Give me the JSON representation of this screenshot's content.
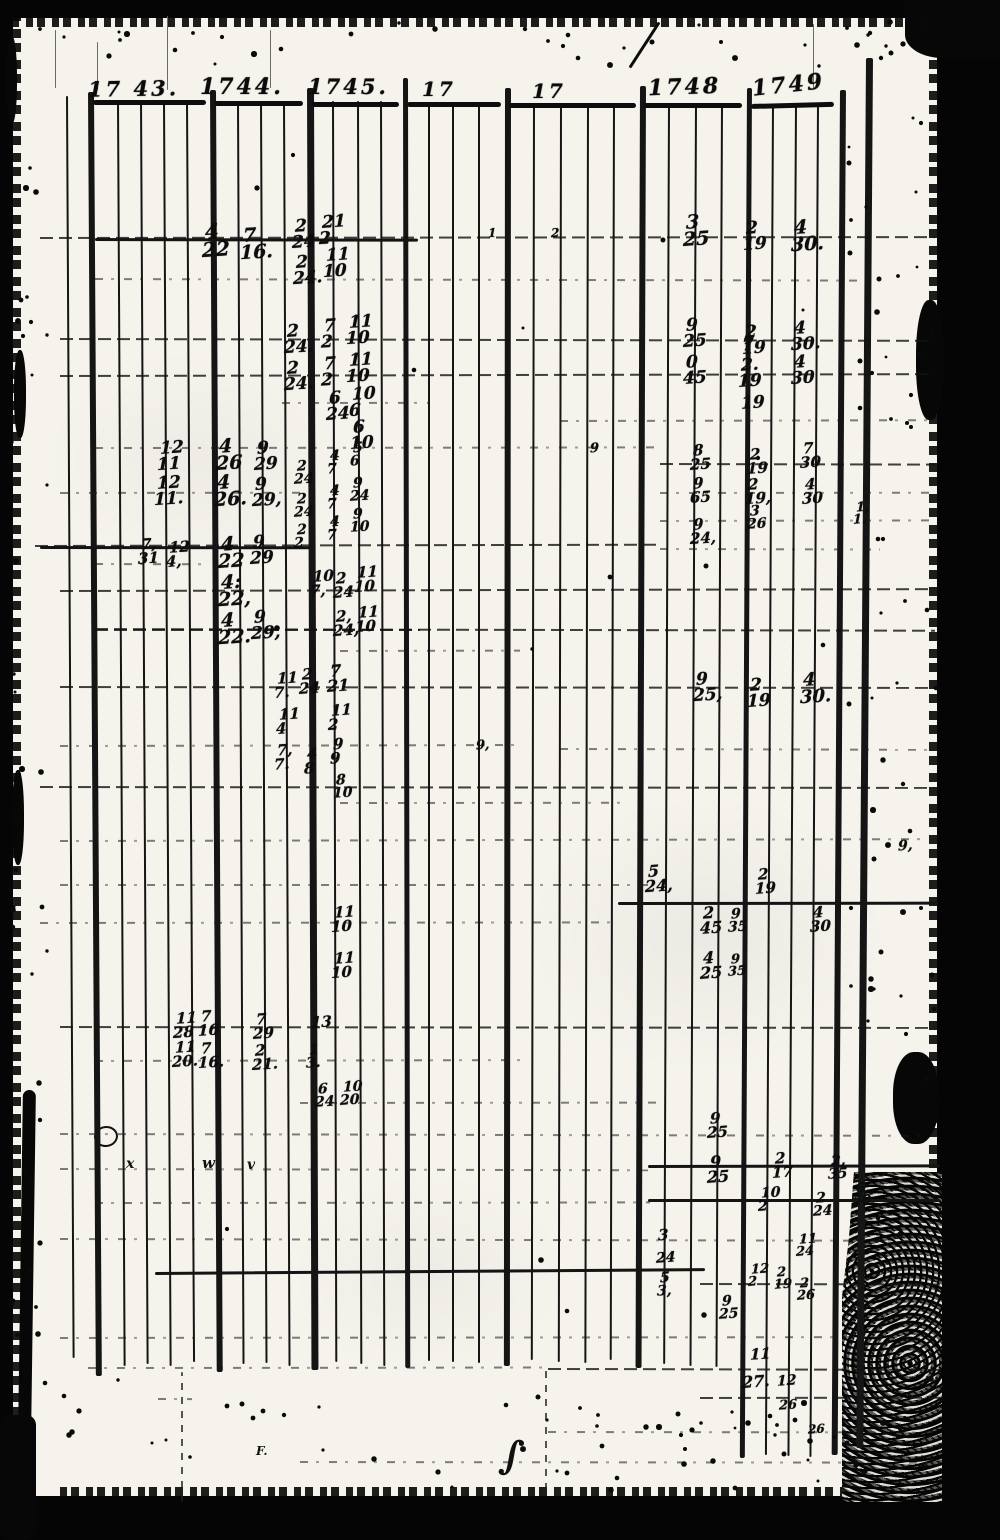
{
  "document": {
    "kind": "scanned handwritten ledger page",
    "header": {
      "years": [
        "17 43.",
        "1744.",
        "1745.",
        "17",
        "17",
        "1748",
        "1749"
      ]
    },
    "ink_color": "#0d0d0d",
    "paper_color": "#f5f3ec"
  },
  "entries": [
    {
      "x": 205,
      "y": 222,
      "t": "4",
      "b": "22",
      "s": 20
    },
    {
      "x": 243,
      "y": 227,
      "t": "7",
      "b": "16.",
      "s": 19
    },
    {
      "x": 295,
      "y": 219,
      "t": "2",
      "b": "24"
    },
    {
      "x": 322,
      "y": 215,
      "t": "21",
      "b": "2"
    },
    {
      "x": 296,
      "y": 255,
      "t": "2",
      "b": "24."
    },
    {
      "x": 326,
      "y": 248,
      "t": "11",
      "b": "10"
    },
    {
      "x": 686,
      "y": 214,
      "t": "3",
      "b": "25",
      "s": 19
    },
    {
      "x": 746,
      "y": 221,
      "t": "2",
      "b": "19"
    },
    {
      "x": 794,
      "y": 219,
      "t": "4",
      "b": "30.",
      "s": 19
    },
    {
      "x": 488,
      "y": 228,
      "t": "1",
      "b": "",
      "s": 12
    },
    {
      "x": 551,
      "y": 228,
      "t": "2",
      "b": "",
      "s": 12
    },
    {
      "x": 287,
      "y": 324,
      "t": "2",
      "b": "24."
    },
    {
      "x": 324,
      "y": 319,
      "t": "7",
      "b": "2"
    },
    {
      "x": 349,
      "y": 315,
      "t": "11",
      "b": "10"
    },
    {
      "x": 287,
      "y": 361,
      "t": "2",
      "b": "24."
    },
    {
      "x": 324,
      "y": 357,
      "t": "7",
      "b": "2"
    },
    {
      "x": 349,
      "y": 353,
      "t": "11",
      "b": "10"
    },
    {
      "x": 329,
      "y": 391,
      "t": "6",
      "b": "24"
    },
    {
      "x": 352,
      "y": 387,
      "t": "10",
      "b": "6"
    },
    {
      "x": 353,
      "y": 420,
      "t": "6",
      "b": "10"
    },
    {
      "x": 686,
      "y": 318,
      "t": "9",
      "b": "25"
    },
    {
      "x": 745,
      "y": 325,
      "t": "2",
      "b": "19"
    },
    {
      "x": 794,
      "y": 321,
      "t": "4",
      "b": "30."
    },
    {
      "x": 686,
      "y": 355,
      "t": "0",
      "b": "45"
    },
    {
      "x": 742,
      "y": 338,
      "t": "7",
      "b": ""
    },
    {
      "x": 741,
      "y": 358,
      "t": "2.",
      "b": "19"
    },
    {
      "x": 741,
      "y": 396,
      "t": "19",
      "b": ""
    },
    {
      "x": 794,
      "y": 355,
      "t": "4",
      "b": "30"
    },
    {
      "x": 160,
      "y": 441,
      "t": "12",
      "b": "11"
    },
    {
      "x": 219,
      "y": 438,
      "t": "4",
      "b": "26",
      "s": 19
    },
    {
      "x": 257,
      "y": 441,
      "t": "9",
      "b": "29"
    },
    {
      "x": 157,
      "y": 476,
      "t": "12",
      "b": "11."
    },
    {
      "x": 217,
      "y": 474,
      "t": "4",
      "b": "26.",
      "s": 19
    },
    {
      "x": 255,
      "y": 477,
      "t": "9",
      "b": "29,"
    },
    {
      "x": 297,
      "y": 460,
      "t": "2",
      "b": "24",
      "s": 14
    },
    {
      "x": 330,
      "y": 450,
      "t": "4",
      "b": "7",
      "s": 14
    },
    {
      "x": 353,
      "y": 442,
      "t": "5",
      "b": "6",
      "s": 14
    },
    {
      "x": 297,
      "y": 493,
      "t": "2",
      "b": "24",
      "s": 14
    },
    {
      "x": 330,
      "y": 485,
      "t": "4",
      "b": "7",
      "s": 14
    },
    {
      "x": 353,
      "y": 477,
      "t": "9",
      "b": "24",
      "s": 14
    },
    {
      "x": 297,
      "y": 524,
      "t": "2",
      "b": "2",
      "s": 14
    },
    {
      "x": 330,
      "y": 516,
      "t": "4",
      "b": "7",
      "s": 14
    },
    {
      "x": 353,
      "y": 508,
      "t": "9",
      "b": "10",
      "s": 14
    },
    {
      "x": 693,
      "y": 444,
      "t": "8",
      "b": "25",
      "s": 15
    },
    {
      "x": 750,
      "y": 448,
      "t": "2",
      "b": "19",
      "s": 15
    },
    {
      "x": 803,
      "y": 442,
      "t": "7",
      "b": "30",
      "s": 15
    },
    {
      "x": 693,
      "y": 477,
      "t": "9",
      "b": "65",
      "s": 15
    },
    {
      "x": 748,
      "y": 478,
      "t": "2",
      "b": "19,",
      "s": 15
    },
    {
      "x": 805,
      "y": 478,
      "t": "4",
      "b": "30",
      "s": 15
    },
    {
      "x": 693,
      "y": 518,
      "t": "9",
      "b": "24,",
      "s": 15
    },
    {
      "x": 750,
      "y": 505,
      "t": "3",
      "b": "26",
      "s": 14
    },
    {
      "x": 856,
      "y": 502,
      "t": "1,",
      "b": "1.",
      "s": 13
    },
    {
      "x": 141,
      "y": 538,
      "t": "7,",
      "b": "31",
      "s": 15
    },
    {
      "x": 169,
      "y": 541,
      "t": "12",
      "b": "4,",
      "s": 15
    },
    {
      "x": 221,
      "y": 536,
      "t": "4",
      "b": "22",
      "s": 19
    },
    {
      "x": 253,
      "y": 535,
      "t": "9",
      "b": "29"
    },
    {
      "x": 221,
      "y": 574,
      "t": "4:",
      "b": "22,",
      "s": 19
    },
    {
      "x": 313,
      "y": 570,
      "t": "10",
      "b": "7,",
      "s": 15
    },
    {
      "x": 336,
      "y": 572,
      "t": "2",
      "b": "24",
      "s": 15
    },
    {
      "x": 357,
      "y": 566,
      "t": "11",
      "b": "10",
      "s": 15
    },
    {
      "x": 221,
      "y": 612,
      "t": "4",
      "b": "22.",
      "s": 19
    },
    {
      "x": 254,
      "y": 610,
      "t": "9",
      "b": "29,"
    },
    {
      "x": 336,
      "y": 610,
      "t": "2,",
      "b": "24,",
      "s": 15
    },
    {
      "x": 358,
      "y": 606,
      "t": "11",
      "b": "10",
      "s": 15
    },
    {
      "x": 277,
      "y": 672,
      "t": "11",
      "b": "7.",
      "s": 15
    },
    {
      "x": 302,
      "y": 668,
      "t": "2",
      "b": "24",
      "s": 15
    },
    {
      "x": 330,
      "y": 664,
      "t": "7",
      "b": "21",
      "s": 16
    },
    {
      "x": 279,
      "y": 708,
      "t": "11",
      "b": "4",
      "s": 15
    },
    {
      "x": 331,
      "y": 704,
      "t": "11",
      "b": "2",
      "s": 15
    },
    {
      "x": 277,
      "y": 744,
      "t": "7,",
      "b": "7.",
      "s": 15
    },
    {
      "x": 307,
      "y": 748,
      "t": "4",
      "b": "8",
      "s": 15
    },
    {
      "x": 333,
      "y": 738,
      "t": "9",
      "b": "9",
      "s": 15
    },
    {
      "x": 336,
      "y": 774,
      "t": "8",
      "b": "10",
      "s": 14
    },
    {
      "x": 696,
      "y": 672,
      "t": "9",
      "b": "25,",
      "s": 17
    },
    {
      "x": 750,
      "y": 678,
      "t": "2",
      "b": "19",
      "s": 17
    },
    {
      "x": 803,
      "y": 672,
      "t": "4",
      "b": "30.",
      "s": 18
    },
    {
      "x": 476,
      "y": 740,
      "t": "9,",
      "b": "",
      "s": 13
    },
    {
      "x": 590,
      "y": 443,
      "t": "9",
      "b": "",
      "s": 13
    },
    {
      "x": 648,
      "y": 864,
      "t": "5",
      "b": "24,",
      "s": 16
    },
    {
      "x": 758,
      "y": 868,
      "t": "2",
      "b": "19",
      "s": 15
    },
    {
      "x": 334,
      "y": 906,
      "t": "11",
      "b": "10",
      "s": 15
    },
    {
      "x": 334,
      "y": 952,
      "t": "11",
      "b": "10",
      "s": 15
    },
    {
      "x": 703,
      "y": 906,
      "t": "2",
      "b": "45",
      "s": 16
    },
    {
      "x": 731,
      "y": 908,
      "t": "9",
      "b": "35",
      "s": 14
    },
    {
      "x": 813,
      "y": 906,
      "t": "4",
      "b": "30",
      "s": 15
    },
    {
      "x": 703,
      "y": 951,
      "t": "4",
      "b": "25",
      "s": 16
    },
    {
      "x": 731,
      "y": 954,
      "t": "9",
      "b": "35",
      "s": 13
    },
    {
      "x": 898,
      "y": 840,
      "t": "9,",
      "b": "",
      "s": 14
    },
    {
      "x": 176,
      "y": 1012,
      "t": "11",
      "b": "28",
      "s": 15
    },
    {
      "x": 201,
      "y": 1010,
      "t": "7",
      "b": "16",
      "s": 15
    },
    {
      "x": 256,
      "y": 1013,
      "t": "7",
      "b": "29",
      "s": 15
    },
    {
      "x": 311,
      "y": 1016,
      "t": "13",
      "b": "",
      "s": 15
    },
    {
      "x": 175,
      "y": 1041,
      "t": "11",
      "b": "20.",
      "s": 15
    },
    {
      "x": 201,
      "y": 1042,
      "t": "7",
      "b": "16.",
      "s": 15
    },
    {
      "x": 255,
      "y": 1044,
      "t": "2",
      "b": "21.",
      "s": 15
    },
    {
      "x": 309,
      "y": 1044,
      "t": "1",
      "b": "3.",
      "s": 14
    },
    {
      "x": 318,
      "y": 1083,
      "t": "6",
      "b": "24",
      "s": 14
    },
    {
      "x": 343,
      "y": 1081,
      "t": "10",
      "b": "20",
      "s": 14
    },
    {
      "x": 710,
      "y": 1112,
      "t": "9",
      "b": "25",
      "s": 15
    },
    {
      "x": 710,
      "y": 1155,
      "t": "9",
      "b": "25",
      "s": 16
    },
    {
      "x": 775,
      "y": 1152,
      "t": "2",
      "b": "17",
      "s": 15
    },
    {
      "x": 831,
      "y": 1155,
      "t": "2,",
      "b": "35",
      "s": 14
    },
    {
      "x": 761,
      "y": 1187,
      "t": "10",
      "b": "2",
      "s": 14
    },
    {
      "x": 816,
      "y": 1192,
      "t": "2",
      "b": "24",
      "s": 14
    },
    {
      "x": 856,
      "y": 1183,
      "t": "6,",
      "b": "50",
      "s": 13
    },
    {
      "x": 658,
      "y": 1229,
      "t": "3",
      "b": "",
      "s": 15
    },
    {
      "x": 656,
      "y": 1252,
      "t": "24",
      "b": "",
      "s": 14
    },
    {
      "x": 660,
      "y": 1272,
      "t": "5",
      "b": "3,",
      "s": 14
    },
    {
      "x": 751,
      "y": 1264,
      "t": "12",
      "b": "2",
      "s": 13
    },
    {
      "x": 777,
      "y": 1267,
      "t": "2",
      "b": "19",
      "s": 13
    },
    {
      "x": 799,
      "y": 1234,
      "t": "11",
      "b": "24",
      "s": 13
    },
    {
      "x": 800,
      "y": 1278,
      "t": "2",
      "b": "26",
      "s": 13
    },
    {
      "x": 722,
      "y": 1295,
      "t": "9",
      "b": "25",
      "s": 14
    },
    {
      "x": 750,
      "y": 1348,
      "t": "11",
      "b": "",
      "s": 15
    },
    {
      "x": 742,
      "y": 1375,
      "t": "27.",
      "b": "",
      "s": 16
    },
    {
      "x": 777,
      "y": 1375,
      "t": "12",
      "b": "",
      "s": 14
    },
    {
      "x": 779,
      "y": 1400,
      "t": "26",
      "b": "",
      "s": 13
    },
    {
      "x": 808,
      "y": 1424,
      "t": "26",
      "b": "",
      "s": 12
    }
  ],
  "marks": [
    {
      "x": 126,
      "y": 1156,
      "text": "x",
      "s": 14
    },
    {
      "x": 202,
      "y": 1154,
      "text": "w",
      "s": 15
    },
    {
      "x": 247,
      "y": 1157,
      "text": "v",
      "s": 14
    },
    {
      "x": 256,
      "y": 1444,
      "text": "F.",
      "s": 12
    },
    {
      "x": 500,
      "y": 1432,
      "text": "∫",
      "s": 40,
      "rot": 8
    }
  ],
  "grid": {
    "verticals": [
      [
        66,
        96,
        1358,
        2,
        -0.3
      ],
      [
        88,
        92,
        1376,
        6,
        -0.35
      ],
      [
        117,
        100,
        1366,
        2,
        -0.3
      ],
      [
        140,
        100,
        1364,
        2,
        -0.3
      ],
      [
        163,
        101,
        1366,
        2,
        -0.3
      ],
      [
        186,
        101,
        1362,
        2,
        -0.32
      ],
      [
        210,
        90,
        1372,
        6,
        -0.3
      ],
      [
        237,
        101,
        1364,
        2,
        -0.25
      ],
      [
        260,
        101,
        1363,
        2,
        -0.25
      ],
      [
        283,
        101,
        1366,
        2,
        -0.25
      ],
      [
        307,
        88,
        1370,
        7,
        -0.2
      ],
      [
        332,
        101,
        1362,
        2,
        -0.15
      ],
      [
        357,
        101,
        1364,
        2,
        -0.15
      ],
      [
        380,
        101,
        1366,
        2,
        -0.15
      ],
      [
        403,
        78,
        1368,
        5,
        -0.1
      ],
      [
        428,
        104,
        1361,
        2,
        0
      ],
      [
        452,
        104,
        1362,
        2,
        0
      ],
      [
        478,
        104,
        1363,
        2,
        0
      ],
      [
        505,
        88,
        1366,
        6,
        0.05
      ],
      [
        533,
        104,
        1360,
        2,
        0.1
      ],
      [
        560,
        104,
        1362,
        2,
        0.1
      ],
      [
        587,
        104,
        1363,
        2,
        0.12
      ],
      [
        613,
        104,
        1360,
        2,
        0.15
      ],
      [
        640,
        86,
        1368,
        6,
        0.2
      ],
      [
        668,
        105,
        1364,
        2,
        0.22
      ],
      [
        695,
        105,
        1366,
        2,
        0.25
      ],
      [
        721,
        105,
        1367,
        2,
        0.25
      ],
      [
        747,
        88,
        1458,
        5,
        0.3
      ],
      [
        772,
        105,
        1455,
        2,
        0.3
      ],
      [
        795,
        105,
        1456,
        2,
        0.32
      ],
      [
        817,
        105,
        1457,
        2,
        0.32
      ],
      [
        840,
        90,
        1455,
        6,
        0.35
      ],
      [
        866,
        58,
        1448,
        7,
        0.4
      ]
    ],
    "verticals_faint": [
      [
        181,
        1372,
        1502,
        2,
        "dashv"
      ],
      [
        545,
        1370,
        1490,
        2,
        "dashv"
      ],
      [
        167,
        16,
        90,
        1,
        "faint"
      ],
      [
        97,
        42,
        90,
        1,
        "faint"
      ],
      [
        270,
        30,
        88,
        1,
        "faint"
      ],
      [
        813,
        24,
        88,
        1,
        "faint"
      ],
      [
        55,
        30,
        88,
        1,
        "faint"
      ]
    ],
    "horizontals": [
      [
        40,
        935,
        237,
        "m"
      ],
      [
        95,
        872,
        278,
        "d"
      ],
      [
        60,
        935,
        338,
        "m"
      ],
      [
        60,
        935,
        375,
        "m"
      ],
      [
        282,
        430,
        402,
        "d"
      ],
      [
        560,
        935,
        420,
        "d"
      ],
      [
        95,
        655,
        447,
        "d"
      ],
      [
        660,
        935,
        463,
        "m"
      ],
      [
        60,
        300,
        492,
        "d"
      ],
      [
        660,
        935,
        492,
        "d"
      ],
      [
        660,
        935,
        520,
        "d"
      ],
      [
        35,
        660,
        545,
        "m"
      ],
      [
        660,
        880,
        548,
        "d"
      ],
      [
        95,
        210,
        563,
        "d"
      ],
      [
        60,
        935,
        590,
        "m"
      ],
      [
        95,
        935,
        628,
        "m"
      ],
      [
        340,
        520,
        650,
        "d"
      ],
      [
        60,
        935,
        686,
        "m"
      ],
      [
        60,
        520,
        745,
        "d"
      ],
      [
        560,
        935,
        748,
        "d"
      ],
      [
        40,
        935,
        786,
        "m"
      ],
      [
        340,
        620,
        802,
        "d"
      ],
      [
        60,
        935,
        840,
        "d"
      ],
      [
        60,
        650,
        884,
        "d"
      ],
      [
        618,
        938,
        902,
        "s"
      ],
      [
        40,
        620,
        922,
        "d"
      ],
      [
        60,
        935,
        1026,
        "m"
      ],
      [
        95,
        520,
        1060,
        "d"
      ],
      [
        300,
        660,
        1102,
        "d"
      ],
      [
        60,
        935,
        1133,
        "d"
      ],
      [
        60,
        650,
        1168,
        "d"
      ],
      [
        648,
        940,
        1165,
        "s"
      ],
      [
        95,
        650,
        1202,
        "d"
      ],
      [
        648,
        940,
        1199,
        "s"
      ],
      [
        60,
        935,
        1238,
        "d"
      ],
      [
        155,
        705,
        1272,
        "s"
      ],
      [
        700,
        940,
        1283,
        "m"
      ],
      [
        60,
        935,
        1337,
        "d"
      ],
      [
        88,
        545,
        1367,
        "d"
      ],
      [
        548,
        940,
        1368,
        "m"
      ],
      [
        158,
        192,
        1398,
        "d"
      ],
      [
        700,
        940,
        1397,
        "m"
      ],
      [
        548,
        940,
        1431,
        "d"
      ],
      [
        300,
        940,
        1461,
        "d"
      ],
      [
        95,
        418,
        238,
        "s"
      ],
      [
        40,
        310,
        546,
        "s"
      ],
      [
        95,
        420,
        629,
        "m"
      ]
    ],
    "header_underlines": [
      [
        93,
        206,
        100,
        0
      ],
      [
        214,
        303,
        101,
        0
      ],
      [
        311,
        399,
        102,
        0
      ],
      [
        407,
        501,
        102,
        0
      ],
      [
        509,
        636,
        103,
        0
      ],
      [
        644,
        742,
        103,
        0
      ],
      [
        751,
        834,
        104,
        -1.5
      ]
    ],
    "year_positions": [
      {
        "x": 88,
        "y": 76,
        "rot": -1,
        "s": 21
      },
      {
        "x": 200,
        "y": 74,
        "rot": 0,
        "s": 22
      },
      {
        "x": 308,
        "y": 74,
        "rot": 0,
        "s": 21
      },
      {
        "x": 422,
        "y": 77,
        "rot": 0,
        "s": 20
      },
      {
        "x": 532,
        "y": 79,
        "rot": 0,
        "s": 20
      },
      {
        "x": 648,
        "y": 74,
        "rot": -2,
        "s": 22
      },
      {
        "x": 752,
        "y": 72,
        "rot": -6,
        "s": 22
      }
    ]
  }
}
